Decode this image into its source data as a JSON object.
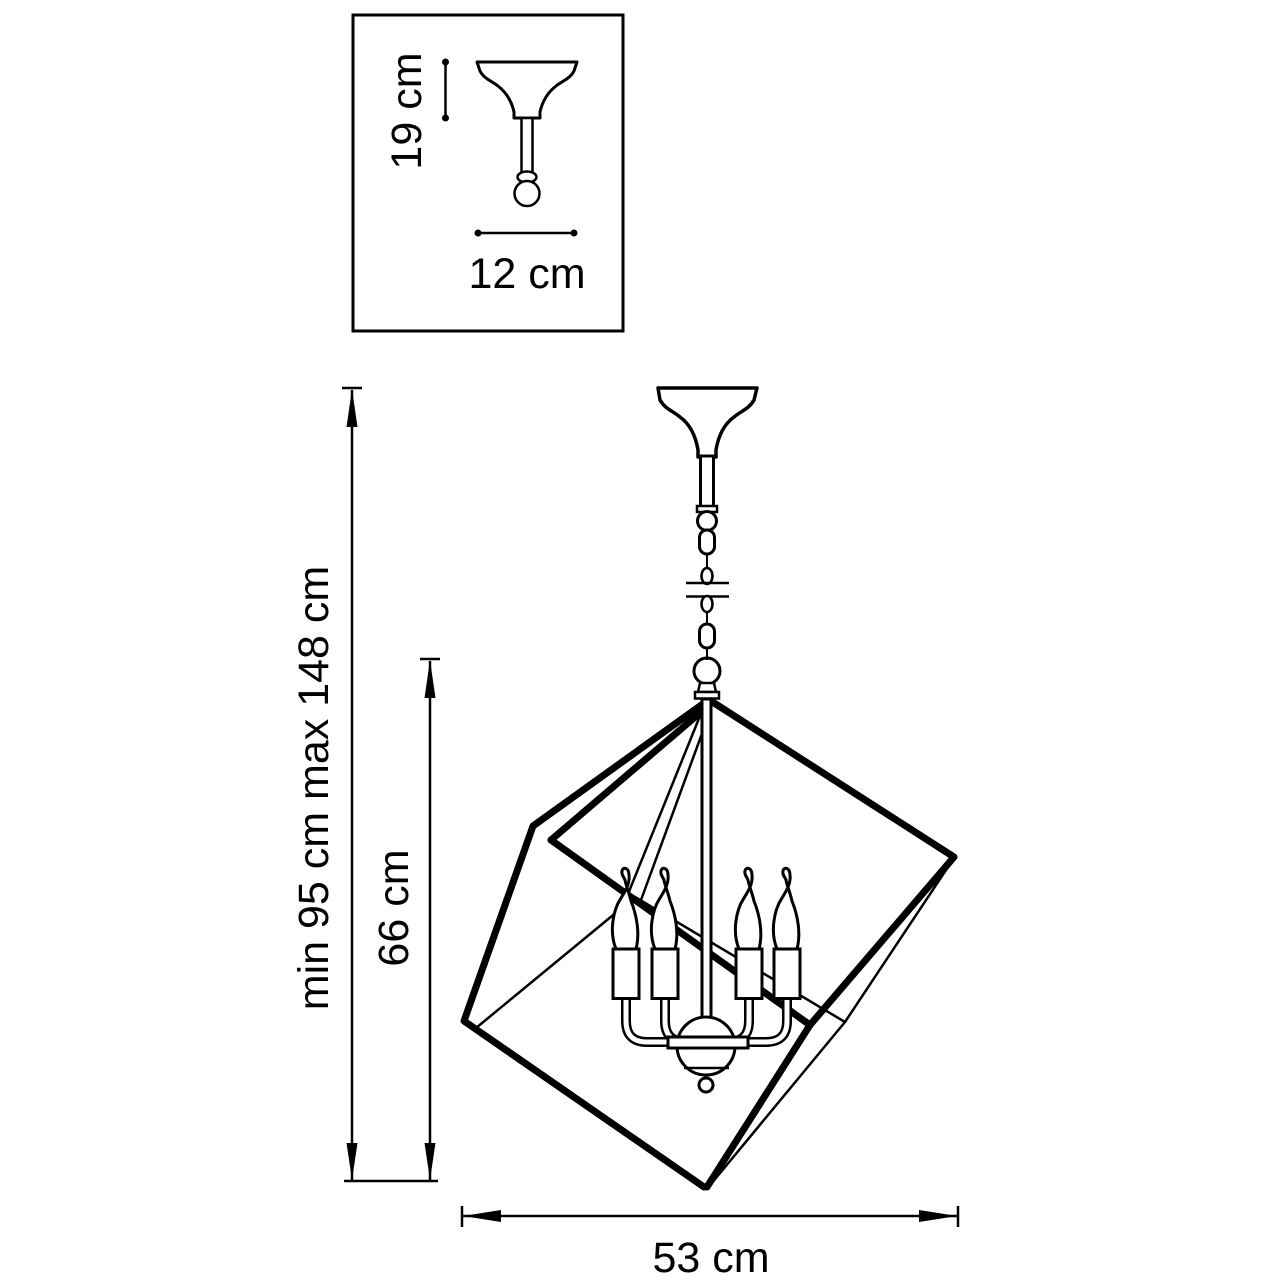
{
  "page": {
    "background_color": "#ffffff",
    "line_color": "#000000",
    "candle_count": 4
  },
  "inset_detail": {
    "height_label": "19 cm",
    "width_label": "12 cm"
  },
  "main_drawing": {
    "overall_height_label": "min 95 cm max 148 cm",
    "cage_height_label": "66 cm",
    "cage_width_label": "53 cm"
  }
}
